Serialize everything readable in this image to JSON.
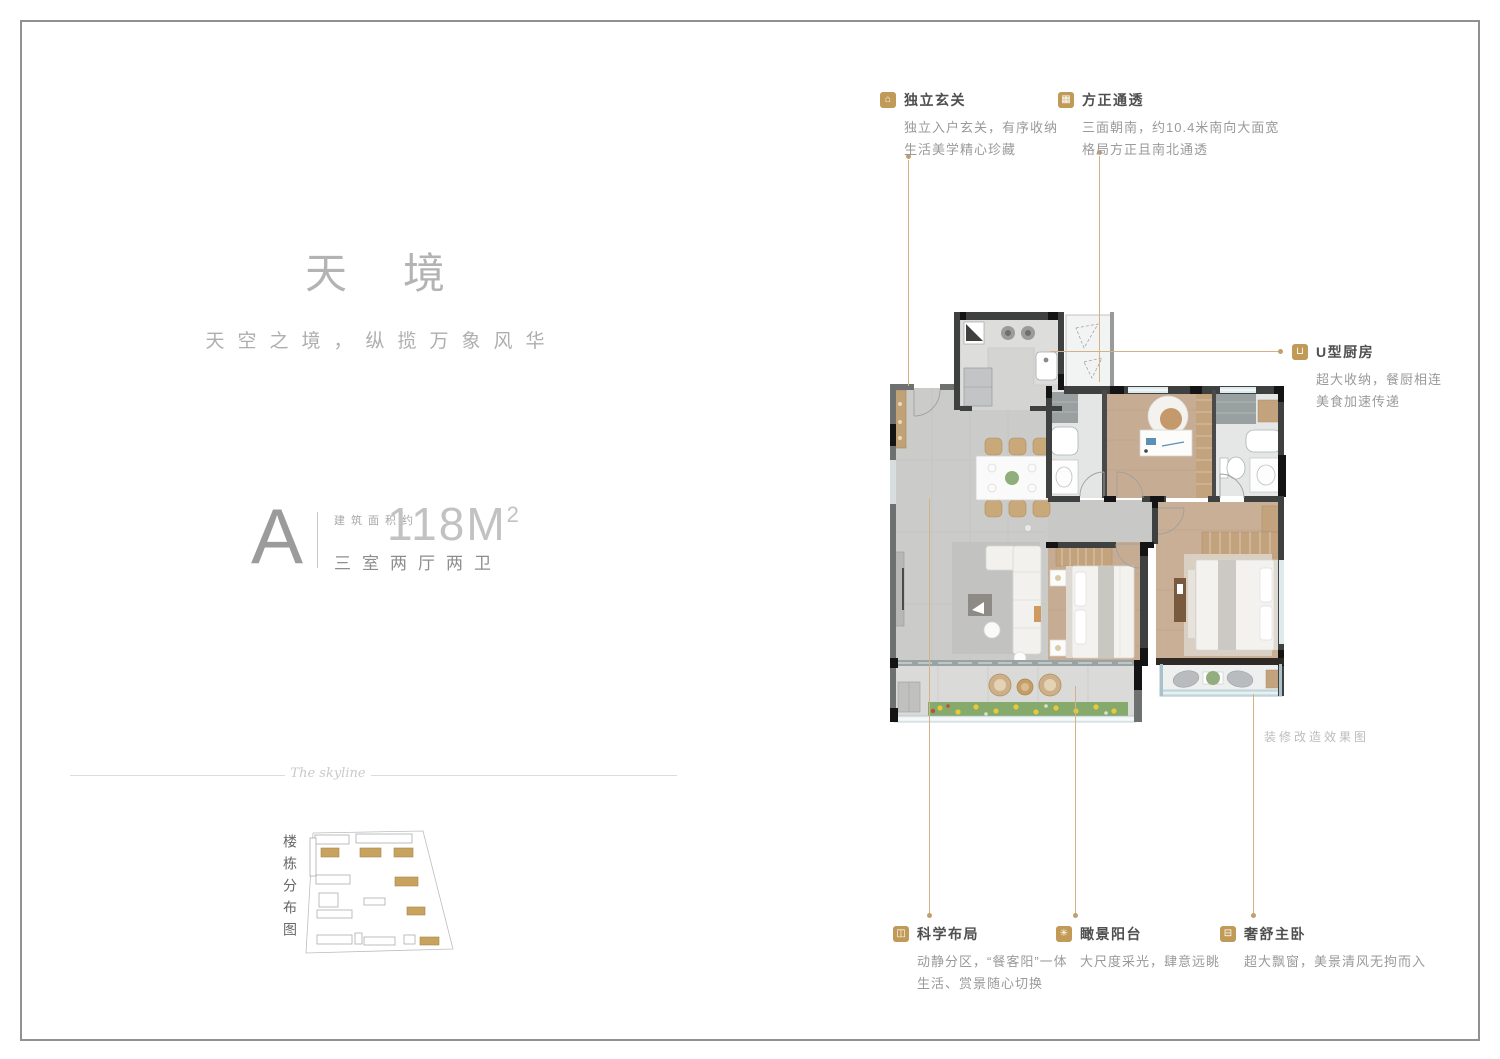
{
  "hero": {
    "title": "天境",
    "subtitle": "天空之境，纵揽万象风华"
  },
  "unit": {
    "letter": "A",
    "area_prefix": "建筑面积约",
    "area_value": "118M",
    "area_sup": "2",
    "layout": "三室两厅两卫"
  },
  "divider": {
    "script": "The skyline"
  },
  "sitemap": {
    "label": "楼栋分布图"
  },
  "plan": {
    "note": "装修改造效果图"
  },
  "callouts": [
    {
      "icon": "⌂",
      "title": "独立玄关",
      "desc1": "独立入户玄关，有序收纳",
      "desc2": "生活美学精心珍藏"
    },
    {
      "icon": "▦",
      "title": "方正通透",
      "desc1": "三面朝南，约10.4米南向大面宽",
      "desc2": "格局方正且南北通透"
    },
    {
      "icon": "⊔",
      "title": "U型厨房",
      "desc1": "超大收纳，餐厨相连",
      "desc2": "美食加速传递"
    },
    {
      "icon": "◫",
      "title": "科学布局",
      "desc1": "动静分区，“餐客阳”一体",
      "desc2": "生活、赏景随心切换"
    },
    {
      "icon": "✳",
      "title": "瞰景阳台",
      "desc1": "大尺度采光，肆意远眺",
      "desc2": ""
    },
    {
      "icon": "⊟",
      "title": "奢舒主卧",
      "desc1": "超大飘窗，美景清风无拘而入",
      "desc2": ""
    }
  ],
  "colors": {
    "accent_gold": "#C09A56",
    "leader_line": "#D2B286",
    "wall_dark": "#3F4040",
    "wood_floor": "#C6AC93",
    "tile_floor": "#CBCBC9",
    "window": "#DFEAEC",
    "title_gray": "#B3B3B3"
  }
}
